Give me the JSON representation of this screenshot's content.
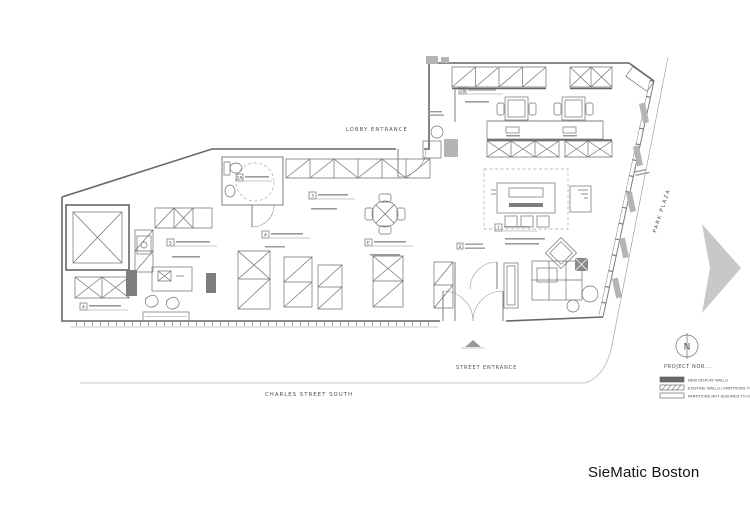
{
  "drawing": {
    "client": "SieMatic Boston",
    "labels": {
      "lobby_entrance": "LOBBY ENTRANCE",
      "street_entrance": "STREET ENTRANCE",
      "charles_street": "CHARLES STREET SOUTH",
      "park_plaza": "PARK PLAZA",
      "project_north": "PROJECT NOR...",
      "north_letter": "N"
    },
    "callouts": [
      {
        "id": "2A"
      },
      {
        "id": "3"
      },
      {
        "id": "4"
      },
      {
        "id": "5"
      },
      {
        "id": "E"
      },
      {
        "id": "1"
      },
      {
        "id": "1B"
      },
      {
        "id": "2"
      },
      {
        "id": "4"
      }
    ],
    "legend": {
      "items": [
        {
          "label": "NEW DISPLAY WALLS",
          "swatch": "solid"
        },
        {
          "label": "EXISTING WALLS / PARTITIONS TO REMAIN",
          "swatch": "hatched"
        },
        {
          "label": "PARTITIONS NOT ASSUMED TO REMAIN",
          "swatch": "outline"
        }
      ]
    },
    "colors": {
      "wall_line": "#666666",
      "light_fill": "#c7c9c8",
      "dark_fill": "#7d7d7d",
      "text": "#4f4f4f"
    }
  }
}
